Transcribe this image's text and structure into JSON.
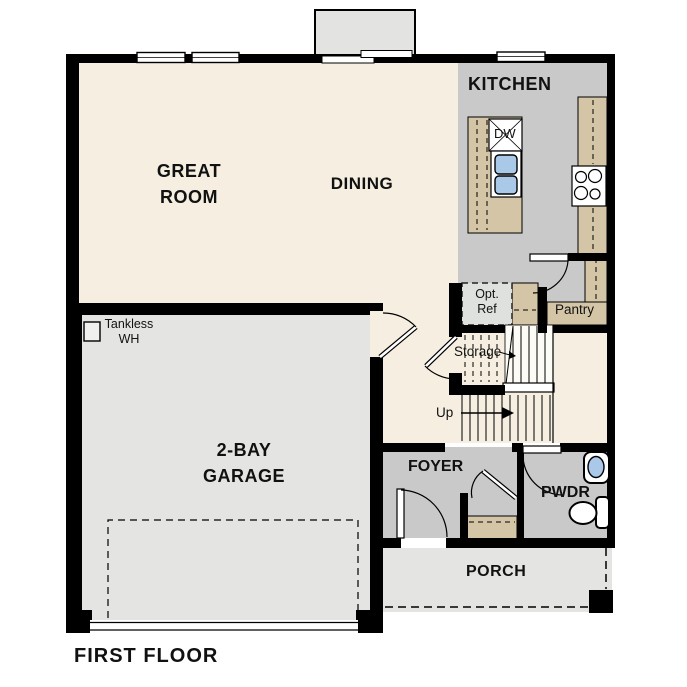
{
  "floor_plan": {
    "title": "FIRST FLOOR",
    "labels": {
      "great_room_l1": "GREAT",
      "great_room_l2": "ROOM",
      "dining": "DINING",
      "kitchen": "KITCHEN",
      "garage_l1": "2-BAY",
      "garage_l2": "GARAGE",
      "foyer": "FOYER",
      "powder": "PWDR",
      "porch": "PORCH",
      "pantry": "Pantry",
      "storage": "Storage",
      "stairs_up": "Up",
      "opt_ref_l1": "Opt.",
      "opt_ref_l2": "Ref",
      "tankless_l1": "Tankless",
      "tankless_l2": "WH",
      "dishwasher": "DW"
    },
    "colors": {
      "floor_cream": "#f6efe1",
      "floor_kitchen_gray": "#c9c9c9",
      "floor_garage_gray": "#e4e4e2",
      "cabinet_tan": "#d4c5a6",
      "fixture_blue": "#aac9e9",
      "wall_black": "#000000",
      "opt_ref_fill": "#dfe1de"
    }
  }
}
